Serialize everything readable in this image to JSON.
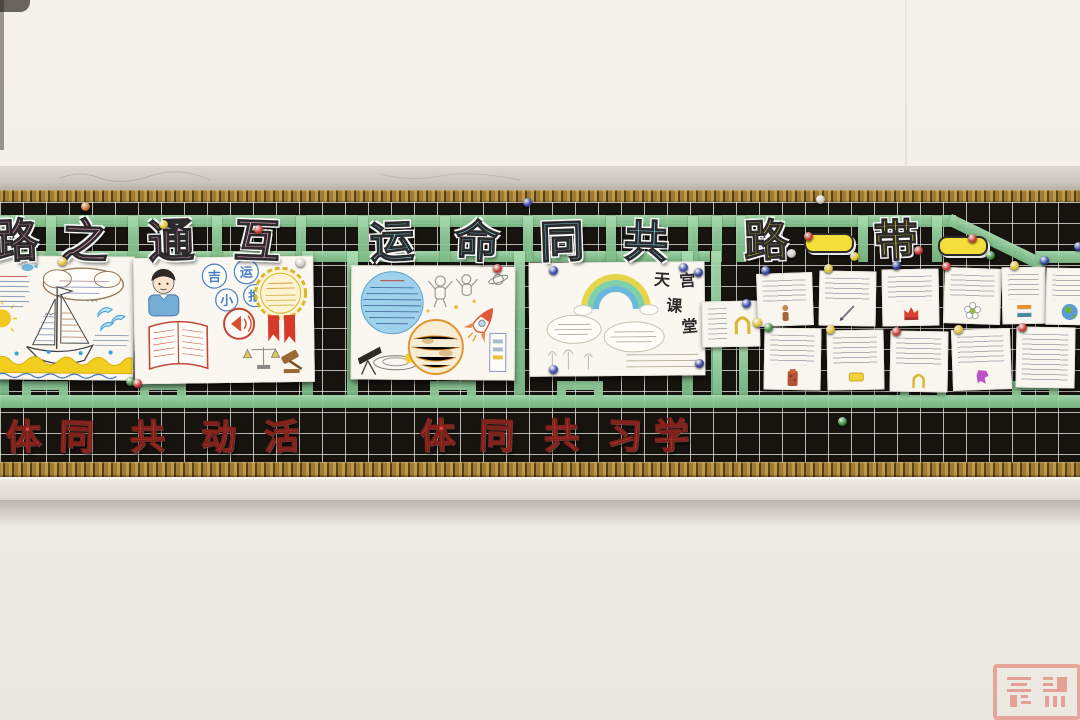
{
  "scene": {
    "description": "Classroom bulletin board photograph: black grid board framed in gold, green tape lattice, paper cut-out Chinese banner characters, hand-drawn student posters and pinned note cards"
  },
  "banners": {
    "top_left": {
      "chars": [
        "路",
        "之",
        "通",
        "互"
      ],
      "color": "#f2a3c8"
    },
    "top_middle": {
      "chars": [
        "运",
        "命",
        "同",
        "共"
      ],
      "color": "#7fd2ec"
    },
    "top_right": {
      "chars": [
        "路",
        "一",
        "带",
        "一"
      ],
      "color": "#f4df3a"
    },
    "bottom_left": {
      "chars": [
        "体",
        "同",
        "共",
        "动",
        "活"
      ],
      "color": "#df4a42"
    },
    "bottom_middle": {
      "chars": [
        "体",
        "同",
        "共",
        "习",
        "学"
      ],
      "color": "#df4a42"
    }
  },
  "posters": {
    "law_news": {
      "circles": [
        "吉",
        "运",
        "小",
        "报"
      ]
    },
    "tiangong": {
      "title": [
        "天",
        "宫",
        "课",
        "堂"
      ]
    }
  },
  "decor": {
    "tapes": [
      [
        0,
        215,
        956,
        12,
        0
      ],
      [
        952,
        214,
        104,
        12,
        26
      ],
      [
        1036,
        251,
        44,
        12,
        0
      ],
      [
        0,
        251,
        710,
        11,
        0
      ],
      [
        0,
        216,
        10,
        46,
        0
      ],
      [
        46,
        216,
        10,
        46,
        0
      ],
      [
        128,
        216,
        10,
        46,
        0
      ],
      [
        212,
        216,
        10,
        46,
        0
      ],
      [
        296,
        216,
        10,
        46,
        0
      ],
      [
        358,
        216,
        10,
        46,
        0
      ],
      [
        440,
        216,
        10,
        46,
        0
      ],
      [
        523,
        216,
        10,
        46,
        0
      ],
      [
        606,
        216,
        10,
        46,
        0
      ],
      [
        688,
        216,
        10,
        46,
        0
      ],
      [
        712,
        216,
        10,
        46,
        0
      ],
      [
        736,
        216,
        10,
        46,
        0
      ],
      [
        858,
        216,
        10,
        46,
        0
      ],
      [
        932,
        216,
        10,
        46,
        0
      ],
      [
        0,
        251,
        9,
        146,
        0
      ],
      [
        302,
        251,
        11,
        146,
        0
      ],
      [
        347,
        251,
        11,
        146,
        0
      ],
      [
        514,
        251,
        11,
        146,
        0
      ],
      [
        682,
        251,
        11,
        146,
        0
      ],
      [
        711,
        251,
        10,
        146,
        0
      ],
      [
        713,
        345,
        9,
        50,
        0
      ],
      [
        739,
        345,
        9,
        50,
        0
      ],
      [
        0,
        395,
        1080,
        13,
        0
      ]
    ],
    "loops": [
      22,
      140,
      430,
      557,
      900,
      1012
    ],
    "cards": [
      [
        702,
        301,
        56,
        44,
        -1,
        "arch",
        "r"
      ],
      [
        757,
        273,
        54,
        51,
        -2,
        "figure",
        ""
      ],
      [
        819,
        271,
        55,
        53,
        1,
        "pen",
        ""
      ],
      [
        882,
        269,
        55,
        55,
        -1,
        "crown",
        ""
      ],
      [
        944,
        268,
        55,
        54,
        2,
        "flower",
        ""
      ],
      [
        1002,
        267,
        42,
        55,
        -1,
        "flag",
        ""
      ],
      [
        1046,
        268,
        46,
        55,
        1,
        "globe",
        ""
      ],
      [
        764,
        328,
        55,
        60,
        1,
        "tower",
        ""
      ],
      [
        827,
        330,
        55,
        58,
        -1,
        "ybox",
        ""
      ],
      [
        890,
        331,
        56,
        59,
        1,
        "arch",
        ""
      ],
      [
        952,
        329,
        57,
        59,
        -2,
        "pmap",
        ""
      ],
      [
        1016,
        327,
        57,
        59,
        1,
        "none",
        ""
      ]
    ],
    "pins": [
      [
        85,
        206,
        "#cf7a2c"
      ],
      [
        163,
        224,
        "#e4c430"
      ],
      [
        258,
        229,
        "#c63a32"
      ],
      [
        527,
        202,
        "#3648ac"
      ],
      [
        683,
        267,
        "#3648ac"
      ],
      [
        820,
        199,
        "#cfccc6"
      ],
      [
        808,
        236,
        "#c63a32"
      ],
      [
        972,
        238,
        "#c63a32"
      ],
      [
        990,
        255,
        "#3d8f42"
      ],
      [
        1044,
        260,
        "#3648ac"
      ],
      [
        62,
        261,
        "#e4c430"
      ],
      [
        300,
        262,
        "#d8d5cf"
      ],
      [
        130,
        381,
        "#3d8f42"
      ],
      [
        137,
        383,
        "#c63a32"
      ],
      [
        497,
        268,
        "#c63a32"
      ],
      [
        553,
        270,
        "#3648ac"
      ],
      [
        698,
        272,
        "#2c3a94"
      ],
      [
        699,
        363,
        "#2c3a94"
      ],
      [
        553,
        369,
        "#3648ac"
      ],
      [
        746,
        303,
        "#3648ac"
      ],
      [
        757,
        322,
        "#e4c430"
      ],
      [
        765,
        270,
        "#3648ac"
      ],
      [
        791,
        253,
        "#d0cfc9"
      ],
      [
        828,
        268,
        "#e4c430"
      ],
      [
        854,
        256,
        "#e4c430"
      ],
      [
        896,
        265,
        "#2c3a94"
      ],
      [
        918,
        250,
        "#c63a32"
      ],
      [
        946,
        266,
        "#c63a32"
      ],
      [
        1014,
        265,
        "#e4c430"
      ],
      [
        1078,
        246,
        "#3648ac"
      ],
      [
        768,
        327,
        "#3d8f42"
      ],
      [
        830,
        329,
        "#e4c430"
      ],
      [
        896,
        331,
        "#c63a32"
      ],
      [
        958,
        329,
        "#e4c430"
      ],
      [
        1022,
        327,
        "#c63a32"
      ],
      [
        842,
        421,
        "#3d8f42"
      ]
    ]
  }
}
